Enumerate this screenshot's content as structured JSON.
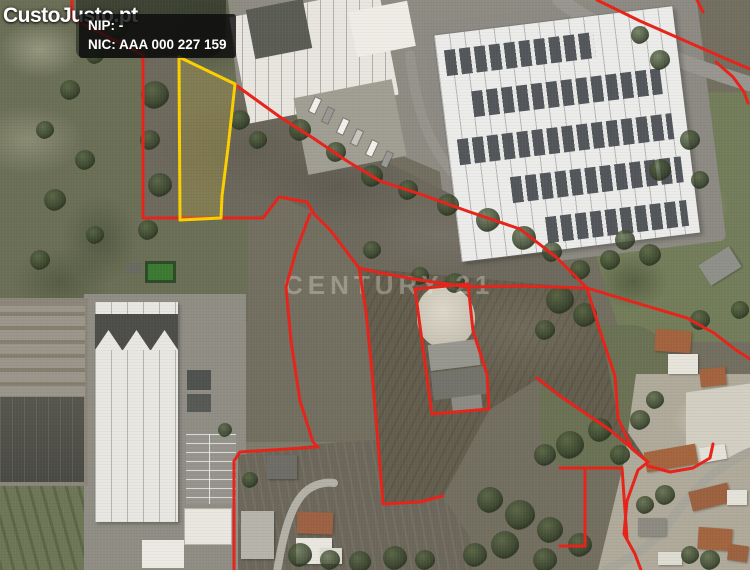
{
  "watermarks": {
    "site_logo": "CustoJusto.pt",
    "agency": "CENTURY 21"
  },
  "label_box": {
    "nip": "NIP: -",
    "nic": "NIC: AAA 000 227 159"
  },
  "map": {
    "boundary_color": "#e8231a",
    "boundary_width": 3,
    "highlight_color": "#fdd000",
    "highlight_parcel": {
      "fill": "rgba(205,190,50,0.22)",
      "points": "179,57 235,84 228,148 222,196 221,218 180,220"
    },
    "boundaries": [
      {
        "id": "west",
        "points": "72,0 72,18 143,55 143,218 263,218 279,197 307,202 314,214 331,231 346,251 359,268"
      },
      {
        "id": "strip-west",
        "points": "359,268 366,312 372,372 378,442 383,504 420,502 443,496"
      },
      {
        "id": "field-north",
        "points": "359,268 381,273 420,280 467,287 520,286 587,288"
      },
      {
        "id": "north-diagonal",
        "points": "237,86 280,117 313,138 347,161 380,181 420,194 467,211 520,229 556,257 587,288"
      },
      {
        "id": "east",
        "points": "587,288 640,304 687,318 714,333 736,350 750,359"
      },
      {
        "id": "south-east",
        "points": "587,288 600,331 615,376 618,418 632,449 648,462 638,470 627,501 624,534 635,554 641,570"
      },
      {
        "id": "farm-compound",
        "points": "415,289 468,284 473,331 487,374 489,409 432,414 424,356 415,289"
      },
      {
        "id": "south-west",
        "points": "310,214 296,251 286,287 291,341 300,401 313,442 318,447 240,452 234,461 234,570"
      },
      {
        "id": "small-parcel",
        "points": "560,468 622,468 627,538"
      },
      {
        "id": "small-parcel-2",
        "points": "585,468 585,546 560,546"
      },
      {
        "id": "road-north",
        "points": "597,0 640,21 690,43 724,58 750,69"
      },
      {
        "id": "road-north-2",
        "points": "716,62 733,77 744,92 748,103"
      },
      {
        "id": "stub-north",
        "points": "697,0 703,12"
      },
      {
        "id": "village-link",
        "points": "537,378 560,396 610,430 648,462"
      },
      {
        "id": "village-loop",
        "points": "648,466 670,472 693,468 710,458 713,444"
      }
    ],
    "roads": [
      {
        "name": "road-top-right",
        "d": "M560,0 C610,38 680,62 750,84",
        "width": 15,
        "color": "#999690"
      },
      {
        "name": "road-industrial",
        "d": "M410,55 C415,100 425,140 452,172",
        "width": 10,
        "color": "#96948c"
      },
      {
        "name": "road-village",
        "d": "M750,452 C712,468 688,496 668,524 C652,546 628,560 606,570",
        "width": 9,
        "color": "#a8a59b"
      },
      {
        "name": "street-bottom",
        "d": "M277,572 C283,534 291,505 305,492 C315,483 327,482 334,483",
        "width": 8,
        "color": "#b4b1a7"
      }
    ],
    "trees": [
      [
        155,
        95,
        14
      ],
      [
        150,
        140,
        10
      ],
      [
        160,
        185,
        12
      ],
      [
        148,
        230,
        10
      ],
      [
        118,
        28,
        10
      ],
      [
        95,
        55,
        9
      ],
      [
        70,
        90,
        10
      ],
      [
        45,
        130,
        9
      ],
      [
        85,
        160,
        10
      ],
      [
        55,
        200,
        11
      ],
      [
        95,
        235,
        9
      ],
      [
        40,
        260,
        10
      ],
      [
        240,
        120,
        10
      ],
      [
        258,
        140,
        9
      ],
      [
        300,
        130,
        11
      ],
      [
        336,
        152,
        10
      ],
      [
        372,
        176,
        11
      ],
      [
        408,
        190,
        10
      ],
      [
        448,
        205,
        11
      ],
      [
        488,
        220,
        12
      ],
      [
        524,
        238,
        12
      ],
      [
        552,
        252,
        10
      ],
      [
        372,
        250,
        9
      ],
      [
        420,
        276,
        9
      ],
      [
        455,
        283,
        10
      ],
      [
        560,
        300,
        14
      ],
      [
        585,
        315,
        12
      ],
      [
        545,
        330,
        10
      ],
      [
        600,
        430,
        12
      ],
      [
        570,
        445,
        14
      ],
      [
        545,
        455,
        11
      ],
      [
        620,
        455,
        10
      ],
      [
        490,
        500,
        13
      ],
      [
        520,
        515,
        15
      ],
      [
        550,
        530,
        13
      ],
      [
        580,
        545,
        12
      ],
      [
        505,
        545,
        14
      ],
      [
        475,
        555,
        12
      ],
      [
        545,
        560,
        12
      ],
      [
        300,
        555,
        12
      ],
      [
        330,
        560,
        10
      ],
      [
        360,
        562,
        11
      ],
      [
        395,
        558,
        12
      ],
      [
        425,
        560,
        10
      ],
      [
        250,
        480,
        8
      ],
      [
        225,
        430,
        7
      ],
      [
        660,
        60,
        10
      ],
      [
        640,
        35,
        9
      ],
      [
        690,
        140,
        10
      ],
      [
        660,
        170,
        11
      ],
      [
        700,
        180,
        9
      ],
      [
        625,
        240,
        10
      ],
      [
        650,
        255,
        11
      ],
      [
        610,
        260,
        10
      ],
      [
        580,
        270,
        10
      ],
      [
        700,
        320,
        10
      ],
      [
        740,
        310,
        9
      ],
      [
        655,
        400,
        9
      ],
      [
        640,
        420,
        10
      ],
      [
        665,
        495,
        10
      ],
      [
        645,
        505,
        9
      ],
      [
        710,
        560,
        10
      ],
      [
        690,
        555,
        9
      ]
    ]
  }
}
